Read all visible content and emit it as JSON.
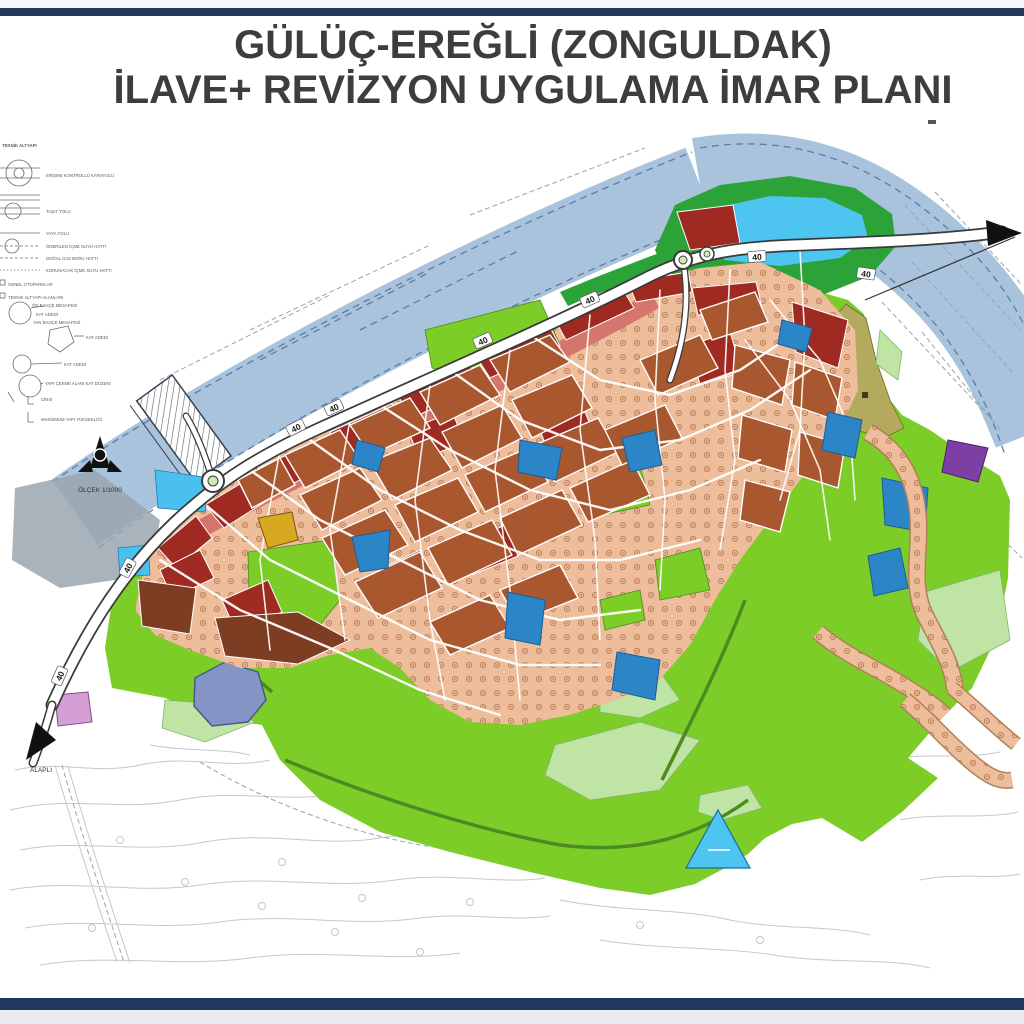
{
  "page": {
    "title_line1": "GÜLÜÇ-EREĞLİ (ZONGULDAK)",
    "title_line2": "İLAVE+ REVİZYON UYGULAMA İMAR PLANI"
  },
  "legend": {
    "header": "TEKNİK ALTYAPI",
    "items": [
      {
        "label": "ERİŞME KONTROLLÜ KARAYOLU",
        "symbol": "interchange-circle"
      },
      {
        "label": "TAŞIT YOLU",
        "symbol": "double-line-road"
      },
      {
        "label": "YAYA YOLU",
        "symbol": "single-line"
      },
      {
        "label": "ÖNERİLEN İÇME SUYU HATTI",
        "symbol": "dashed-line"
      },
      {
        "label": "DOĞAL GAZ BORU HATTI",
        "symbol": "dashed-line"
      },
      {
        "label": "KORUNACAK İÇME SUYU HATTI",
        "symbol": "dashed-line"
      },
      {
        "label": "GENEL OTOPARKLAR",
        "symbol": "small-square"
      },
      {
        "label": "TEKNİK ALTYAPI ALANLARI",
        "symbol": "small-square"
      },
      {
        "label": "ÖN BAHÇE MESAFESİ",
        "symbol": "setback-circle"
      },
      {
        "label": "KAT ADEDİ",
        "symbol": "circle"
      },
      {
        "label": "YAN BAHÇE MESAFESİ",
        "symbol": "setback-circle"
      },
      {
        "label": "KAT ADEDİ",
        "symbol": "parcel-pentagon"
      },
      {
        "label": "KAT ADEDİ",
        "symbol": "circle"
      },
      {
        "label": "YAPI ÇEKME ALANI KAT DÜZENİ",
        "symbol": "circle"
      },
      {
        "label": "CİNSİ",
        "symbol": "bracket"
      },
      {
        "label": "MAKSİMUM YAPI YÜKSEKLİĞİ",
        "symbol": "bracket"
      }
    ],
    "scale_label": "ÖLÇEK 1/1000"
  },
  "map": {
    "road_width_label": "40",
    "direction_southwest": "ALAPLI",
    "colors": {
      "border_navy": "#223a5e",
      "top_strip": "#f3f6fb",
      "below_strip": "#e9ebf0",
      "title_text": "#3d3d3d",
      "river": "#a9c3dd",
      "river_edge": "#5c7ca6",
      "lagoon": "#4ec4f0",
      "green_belt": "#2ca339",
      "park_green": "#7ccd28",
      "light_green": "#bfe4a4",
      "khaki": "#b3aa5e",
      "urban_salmon": "#edbd9c",
      "terracotta": "#a8572f",
      "dark_red": "#9e2a22",
      "brown_dark": "#7c3d22",
      "corridor_pink": "#d4766e",
      "facility_blue": "#2c85c7",
      "cyan_parcel": "#49c0ee",
      "pond_blue": "#8495c5",
      "purple": "#7e3fa5",
      "pink_parcel": "#d49fd4",
      "harbor_gray": "#9aa6af",
      "yellow_parcel": "#d8a820",
      "road_dark": "#3a3a3a",
      "arrow_black": "#111111"
    }
  }
}
